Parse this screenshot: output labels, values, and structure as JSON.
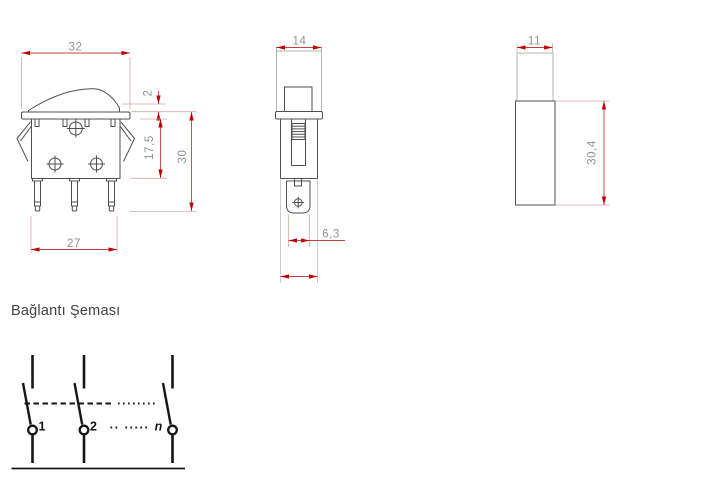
{
  "colors": {
    "background": "#ffffff",
    "object_line": "#4f4f4f",
    "light_line": "#b5b5b5",
    "dimension_line": "#c54040",
    "dimension_arrow": "#c00000",
    "dimension_text": "#959090",
    "schematic_line": "#161616",
    "title_text": "#414141"
  },
  "views": {
    "front": {
      "label": "front-view-rocker-switch",
      "dims": {
        "flange_width": "32",
        "rocker_protrusion": "2",
        "body_height": "17,5",
        "overall_height": "30",
        "bottom_width": "27"
      }
    },
    "side": {
      "label": "side-view",
      "dims": {
        "depth": "14",
        "terminal_width": "6,3"
      }
    },
    "panel": {
      "label": "end-view",
      "dims": {
        "width": "11",
        "height": "30,4"
      }
    }
  },
  "schematic": {
    "title": "Bağlantı Şeması",
    "pole_labels": {
      "first": "1",
      "second": "2",
      "nth": "n"
    },
    "ellipsis_row": ".. ....."
  }
}
